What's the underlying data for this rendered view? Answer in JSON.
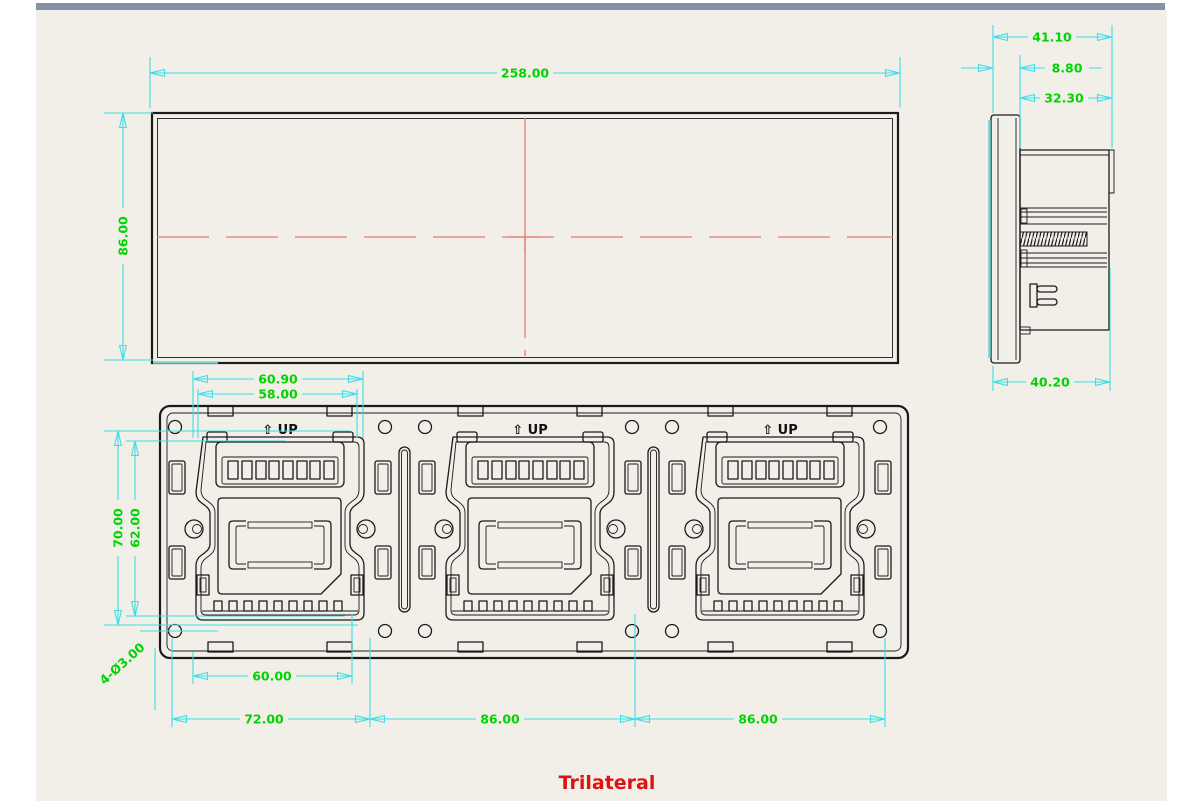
{
  "title": {
    "label": "Trilateral"
  },
  "front_view": {
    "width_mm": "258.00",
    "height_mm": "86.00"
  },
  "side_view": {
    "total_depth": "41.10",
    "faceplate_thickness": "8.80",
    "recess_depth": "32.30",
    "body_depth": "40.20"
  },
  "back_view": {
    "up_label": "⇧ UP",
    "clip_outer_width": "60.90",
    "clip_inner_width": "58.00",
    "frame_height": "70.00",
    "frame_inner_height": "62.00",
    "mounting_holes_note": "4-Ø3.00",
    "slot_width": "60.00",
    "edge_pitch": "72.00",
    "module_pitch_1": "86.00",
    "module_pitch_2": "86.00"
  },
  "colors": {
    "background": "#f2efe9",
    "top_bar": "#8791a7",
    "dimension_line": "#3ae0e8",
    "dimension_text": "#00d400",
    "centerline": "#e87a74",
    "linework": "#1b1b1b",
    "title_text": "#de1310"
  }
}
